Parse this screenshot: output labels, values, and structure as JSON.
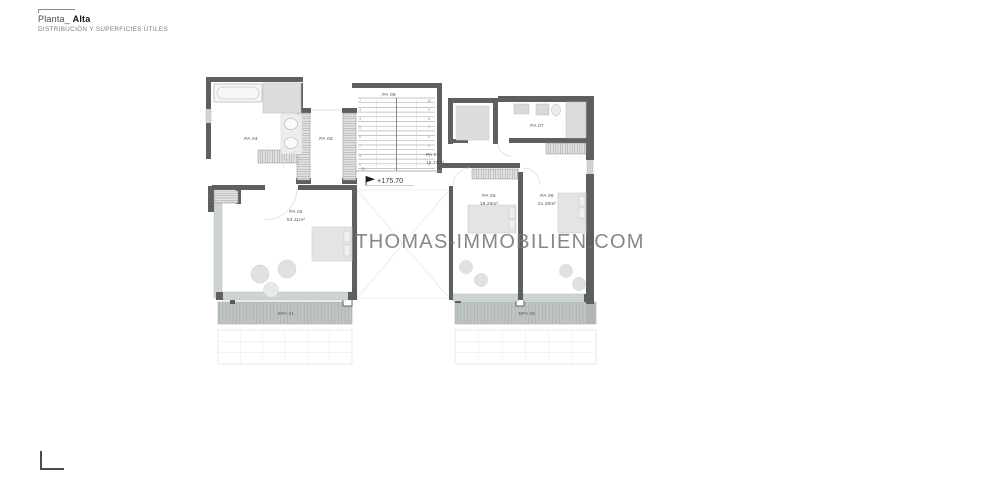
{
  "sheet": {
    "title_prefix": "Planta_",
    "title_emphasis": "Alta",
    "subtitle": "DISTRIBUCIÓN Y SUPERFICIES ÚTILES"
  },
  "watermark": "THOMAS-IMMOBILIEN.COM",
  "plan": {
    "elevation": "+175.70",
    "rooms": {
      "pa01": {
        "id": "PA 01",
        "area": "16.74m²"
      },
      "pa02": {
        "id": "PA 02",
        "area": "53.11m²"
      },
      "pa03": {
        "id": "PA 03"
      },
      "pa04": {
        "id": "PA 04"
      },
      "pa05": {
        "id": "PA 05",
        "area": "18.26m²"
      },
      "pa06": {
        "id": "PA 06",
        "area": "21.30m²"
      },
      "pa07": {
        "id": "PA 07"
      },
      "pa08": {
        "id": "PA 08"
      }
    },
    "terraces": {
      "epa01": {
        "id": "EPA 01"
      },
      "epa02": {
        "id": "EPA 02"
      }
    },
    "stairs": {
      "left_numbers": "2\n3\n4\n5\n6\n7\n8\n9",
      "right_numbers": "10\n9\n8\n7\n6\n5\n4\n3",
      "bottom_number": "20"
    }
  },
  "colors": {
    "wall": "#5f5f5f",
    "furniture": "#e3e3e3",
    "glass": "#ccd4d4",
    "terrace_deck": "#bfc5c5",
    "watermark_gray": "#8c8c8c"
  }
}
